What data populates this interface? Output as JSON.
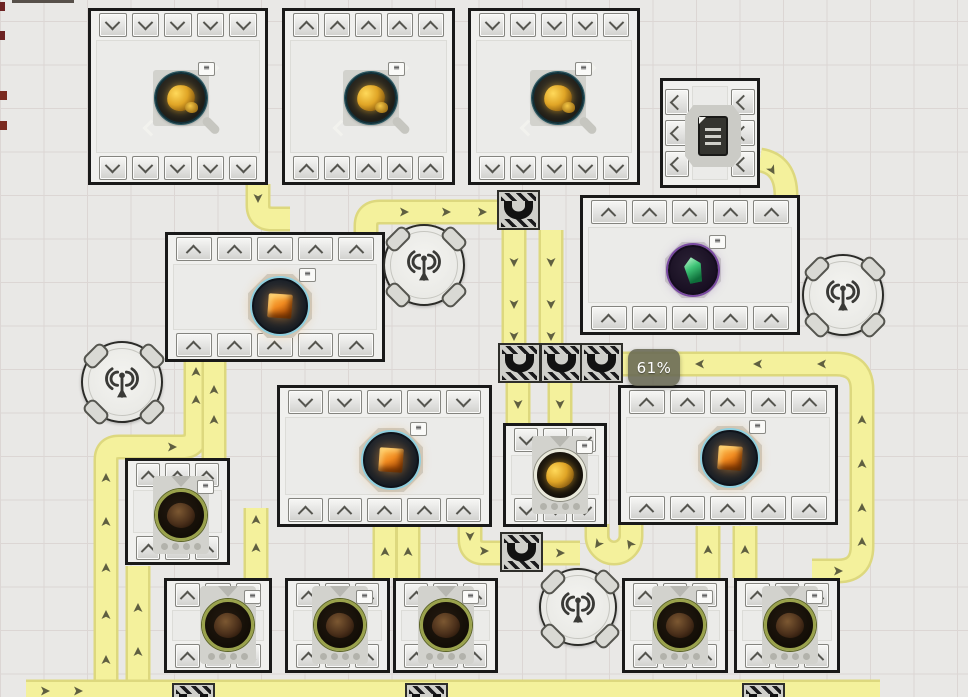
{
  "canvas": {
    "w": 968,
    "h": 697
  },
  "badge": {
    "text": "61%",
    "x": 628,
    "y": 349,
    "w": 52,
    "h": 37
  },
  "colors": {
    "belt": "#f4f19c",
    "belt_edge": "#ddd87e",
    "arrow": "#5f5f40",
    "frame": "#191919",
    "accent_gold": "#e0a526",
    "accent_orange": "#f08a20",
    "accent_green": "#3fc577",
    "accent_purple": "#7a4aa2"
  },
  "belts": {
    "paths": [
      {
        "d": "M 106,702 V 460 Q 106,447 119,447 H 182 Q 196,447 196,433 V 360"
      },
      {
        "d": "M 214,460 V 360"
      },
      {
        "d": "M 138,702 V 566"
      },
      {
        "d": "M 26,692 H 880"
      },
      {
        "d": "M 258,184 V 205 Q 258,219 272,219 H 290"
      },
      {
        "d": "M 366,233 V 226 Q 366,212 380,212 H 500"
      },
      {
        "d": "M 514,230 V 346"
      },
      {
        "d": "M 551,230 V 346"
      },
      {
        "d": "M 518,382 V 424"
      },
      {
        "d": "M 560,382 V 424"
      },
      {
        "d": "M 470,526 V 539 Q 470,553 484,553 H 502"
      },
      {
        "d": "M 541,553 H 580"
      },
      {
        "d": "M 597,524 V 536 A 17,17 0 0 0 631,536 V 524"
      },
      {
        "d": "M 708,578 V 526"
      },
      {
        "d": "M 745,578 V 526"
      },
      {
        "d": "M 385,578 V 526"
      },
      {
        "d": "M 408,578 V 526"
      },
      {
        "d": "M 256,578 V 508"
      },
      {
        "d": "M 618,364 H 836 Q 862,364 862,390 V 546 Q 862,571 838,571 H 812"
      },
      {
        "d": "M 760,160 Q 786,164 786,196"
      }
    ],
    "arrows": [
      [
        106,
        660,
        0
      ],
      [
        106,
        615,
        0
      ],
      [
        106,
        568,
        0
      ],
      [
        106,
        522,
        0
      ],
      [
        106,
        478,
        0
      ],
      [
        172,
        447,
        90
      ],
      [
        196,
        400,
        0
      ],
      [
        196,
        372,
        0
      ],
      [
        214,
        420,
        0
      ],
      [
        214,
        390,
        0
      ],
      [
        138,
        652,
        0
      ],
      [
        138,
        608,
        0
      ],
      [
        45,
        691,
        90
      ],
      [
        78,
        691,
        90
      ],
      [
        256,
        548,
        0
      ],
      [
        256,
        520,
        0
      ],
      [
        385,
        552,
        0
      ],
      [
        408,
        552,
        0
      ],
      [
        258,
        198,
        180
      ],
      [
        404,
        212,
        90
      ],
      [
        446,
        212,
        90
      ],
      [
        482,
        212,
        90
      ],
      [
        514,
        262,
        180
      ],
      [
        514,
        304,
        180
      ],
      [
        514,
        336,
        180
      ],
      [
        551,
        262,
        180
      ],
      [
        551,
        304,
        180
      ],
      [
        551,
        336,
        180
      ],
      [
        518,
        404,
        180
      ],
      [
        560,
        404,
        180
      ],
      [
        470,
        536,
        180
      ],
      [
        484,
        551,
        90
      ],
      [
        560,
        553,
        90
      ],
      [
        598,
        544,
        215
      ],
      [
        630,
        544,
        325
      ],
      [
        708,
        550,
        0
      ],
      [
        745,
        550,
        0
      ],
      [
        700,
        364,
        270
      ],
      [
        758,
        364,
        270
      ],
      [
        822,
        364,
        270
      ],
      [
        862,
        420,
        0
      ],
      [
        862,
        464,
        0
      ],
      [
        862,
        508,
        0
      ],
      [
        862,
        542,
        0
      ],
      [
        838,
        571,
        90
      ],
      [
        772,
        170,
        150
      ]
    ]
  },
  "tunnels": [
    {
      "x": 497,
      "y": 190
    },
    {
      "x": 498,
      "y": 343
    },
    {
      "x": 540,
      "y": 343
    },
    {
      "x": 580,
      "y": 343
    },
    {
      "x": 500,
      "y": 532
    },
    {
      "x": 172,
      "y": 683
    },
    {
      "x": 405,
      "y": 683
    },
    {
      "x": 742,
      "y": 683
    }
  ],
  "buildings": [
    {
      "id": "extractor-1",
      "x": 88,
      "y": 8,
      "w": 180,
      "h": 177,
      "top": {
        "n": 5,
        "dir": "down"
      },
      "bottom": {
        "n": 5,
        "dir": "down"
      },
      "machine": {
        "type": "extractor_gold",
        "cx": 90,
        "cy": 87
      }
    },
    {
      "id": "extractor-2",
      "x": 282,
      "y": 8,
      "w": 173,
      "h": 177,
      "top": {
        "n": 5,
        "dir": "up"
      },
      "bottom": {
        "n": 5,
        "dir": "up"
      },
      "machine": {
        "type": "extractor_gold",
        "cx": 86,
        "cy": 87
      }
    },
    {
      "id": "extractor-3",
      "x": 468,
      "y": 8,
      "w": 172,
      "h": 177,
      "top": {
        "n": 5,
        "dir": "down"
      },
      "bottom": {
        "n": 5,
        "dir": "down"
      },
      "machine": {
        "type": "extractor_gold",
        "cx": 87,
        "cy": 87
      }
    },
    {
      "id": "storage",
      "x": 660,
      "y": 78,
      "w": 100,
      "h": 110,
      "left": {
        "n": 3,
        "dir": "left"
      },
      "right": {
        "n": 3,
        "dir": "left"
      },
      "machine": {
        "type": "storage",
        "cx": 50,
        "cy": 55
      }
    },
    {
      "id": "processor-1",
      "x": 165,
      "y": 232,
      "w": 220,
      "h": 130,
      "top": {
        "n": 5,
        "dir": "up"
      },
      "bottom": {
        "n": 5,
        "dir": "up"
      },
      "machine": {
        "type": "cube_orange",
        "cx": 112,
        "cy": 71
      }
    },
    {
      "id": "crystal-plant",
      "x": 580,
      "y": 195,
      "w": 220,
      "h": 140,
      "top": {
        "n": 5,
        "dir": "up"
      },
      "bottom": {
        "n": 5,
        "dir": "up"
      },
      "machine": {
        "type": "crystal_green",
        "cx": 110,
        "cy": 72
      }
    },
    {
      "id": "processor-2",
      "x": 277,
      "y": 385,
      "w": 215,
      "h": 142,
      "top": {
        "n": 5,
        "dir": "down"
      },
      "bottom": {
        "n": 5,
        "dir": "up"
      },
      "machine": {
        "type": "cube_orange",
        "cx": 111,
        "cy": 72
      }
    },
    {
      "id": "smelter-gold",
      "x": 503,
      "y": 423,
      "w": 104,
      "h": 104,
      "top": {
        "n": 3,
        "dir": "down"
      },
      "bottom": {
        "n": 3,
        "dir": "down"
      },
      "machine": {
        "type": "smelter_gold",
        "cx": 54,
        "cy": 49
      }
    },
    {
      "id": "processor-3",
      "x": 618,
      "y": 385,
      "w": 220,
      "h": 140,
      "top": {
        "n": 5,
        "dir": "up"
      },
      "bottom": {
        "n": 5,
        "dir": "up"
      },
      "machine": {
        "type": "cube_orange",
        "cx": 109,
        "cy": 70
      }
    },
    {
      "id": "smelter-a",
      "x": 125,
      "y": 458,
      "w": 105,
      "h": 107,
      "top": {
        "n": 3,
        "dir": "up"
      },
      "bottom": {
        "n": 3,
        "dir": "up"
      },
      "machine": {
        "type": "smelter_dark",
        "cx": 53,
        "cy": 54
      }
    },
    {
      "id": "smelter-b",
      "x": 164,
      "y": 578,
      "w": 108,
      "h": 95,
      "top": {
        "n": 3,
        "dir": "up"
      },
      "bottom": {
        "n": 3,
        "dir": "up"
      },
      "machine": {
        "type": "smelter_dark",
        "cx": 61,
        "cy": 44
      }
    },
    {
      "id": "smelter-c",
      "x": 285,
      "y": 578,
      "w": 105,
      "h": 95,
      "top": {
        "n": 3,
        "dir": "up"
      },
      "bottom": {
        "n": 3,
        "dir": "up"
      },
      "machine": {
        "type": "smelter_dark",
        "cx": 52,
        "cy": 44
      }
    },
    {
      "id": "smelter-d",
      "x": 393,
      "y": 578,
      "w": 105,
      "h": 95,
      "top": {
        "n": 3,
        "dir": "up"
      },
      "bottom": {
        "n": 3,
        "dir": "up"
      },
      "machine": {
        "type": "smelter_dark",
        "cx": 50,
        "cy": 44
      }
    },
    {
      "id": "smelter-e",
      "x": 622,
      "y": 578,
      "w": 106,
      "h": 95,
      "top": {
        "n": 3,
        "dir": "up"
      },
      "bottom": {
        "n": 3,
        "dir": "up"
      },
      "machine": {
        "type": "smelter_dark",
        "cx": 55,
        "cy": 44
      }
    },
    {
      "id": "smelter-f",
      "x": 734,
      "y": 578,
      "w": 106,
      "h": 95,
      "top": {
        "n": 3,
        "dir": "up"
      },
      "bottom": {
        "n": 3,
        "dir": "up"
      },
      "machine": {
        "type": "smelter_dark",
        "cx": 53,
        "cy": 44
      }
    }
  ],
  "antennas": [
    {
      "cx": 424,
      "cy": 265,
      "r": 39
    },
    {
      "cx": 843,
      "cy": 295,
      "r": 39
    },
    {
      "cx": 122,
      "cy": 382,
      "r": 39
    },
    {
      "cx": 578,
      "cy": 607,
      "r": 37
    }
  ],
  "edge_marks": [
    {
      "x": 0,
      "y": 2,
      "w": 5,
      "h": 9,
      "c": "#6d2323"
    },
    {
      "x": 0,
      "y": 31,
      "w": 5,
      "h": 9,
      "c": "#6d2323"
    },
    {
      "x": 0,
      "y": 91,
      "w": 7,
      "h": 9,
      "c": "#7a2a20"
    },
    {
      "x": 0,
      "y": 121,
      "w": 7,
      "h": 9,
      "c": "#7a2a20"
    },
    {
      "x": 12,
      "y": 0,
      "w": 62,
      "h": 3,
      "c": "#57504a"
    }
  ]
}
